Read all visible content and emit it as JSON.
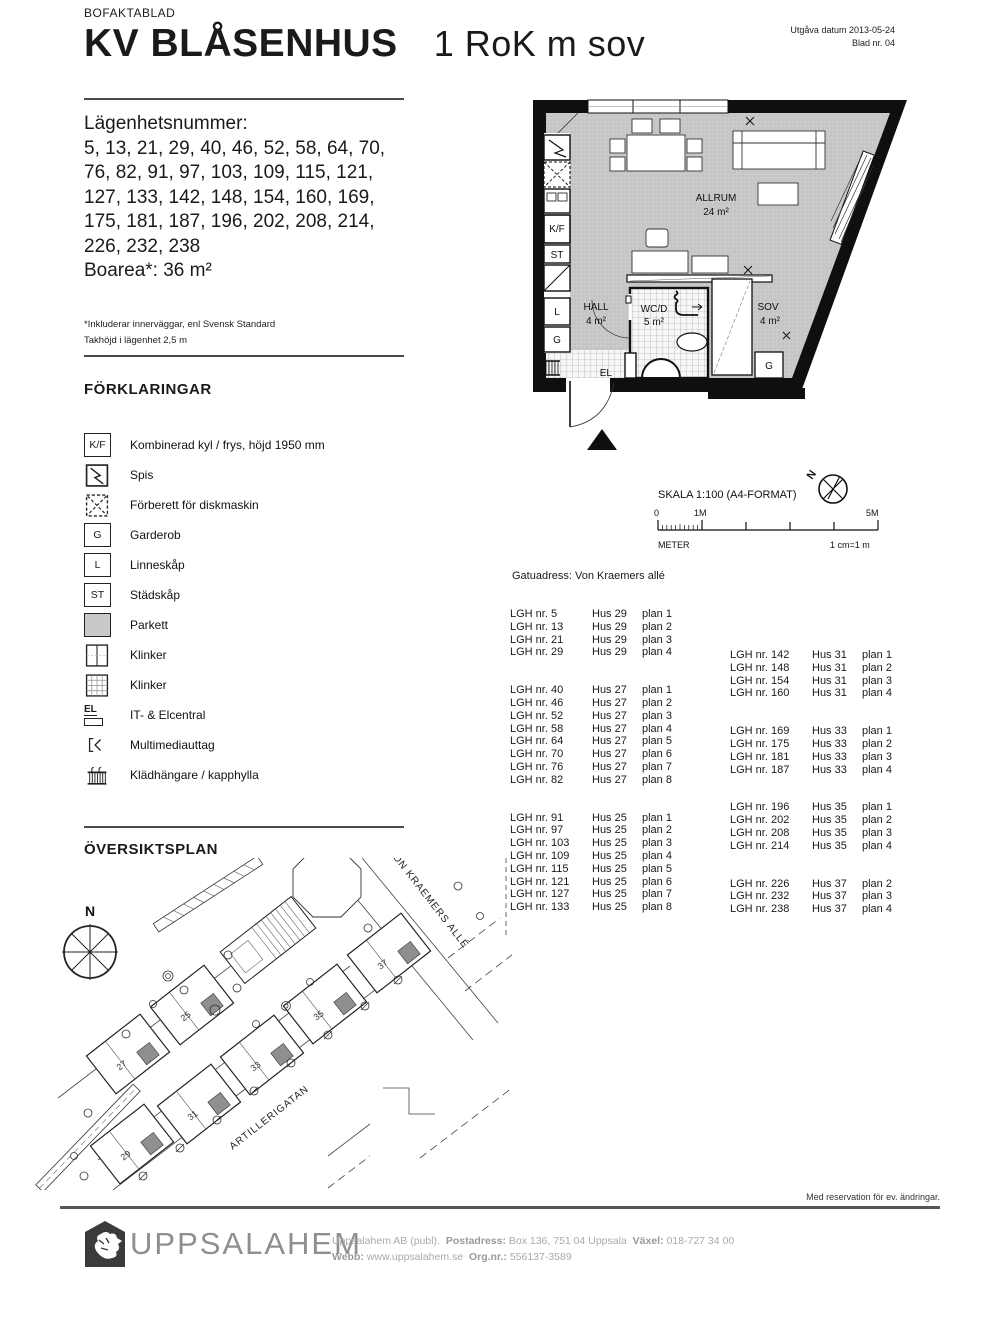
{
  "header": {
    "doc_type": "BOFAKTABLAD",
    "title": "KV BLÅSENHUS",
    "subtitle": "1 RoK m sov",
    "issue_date": "Utgåva datum 2013-05-24",
    "sheet_no": "Blad nr. 04"
  },
  "apartment": {
    "numbers_label": "Lägenhetsnummer:",
    "numbers": "5, 13, 21, 29, 40, 46, 52, 58, 64, 70, 76, 82, 91, 97, 103, 109, 115, 121, 127, 133, 142, 148, 154, 160, 169, 175, 181, 187, 196, 202, 208, 214, 226, 232, 238",
    "boarea": "Boarea*: 36 m²",
    "footnote1": "*Inkluderar innerväggar, enl Svensk Standard",
    "footnote2": "Takhöjd i lägenhet 2,5 m"
  },
  "legend": {
    "title": "FÖRKLARINGAR",
    "items": [
      {
        "icon": "kf-box",
        "symbol": "K/F",
        "label": "Kombinerad kyl / frys, höjd 1950 mm"
      },
      {
        "icon": "stove",
        "label": "Spis"
      },
      {
        "icon": "dishwasher",
        "label": "Förberett för diskmaskin"
      },
      {
        "icon": "g-box",
        "symbol": "G",
        "label": "Garderob"
      },
      {
        "icon": "l-box",
        "symbol": "L",
        "label": "Linneskåp"
      },
      {
        "icon": "st-box",
        "symbol": "ST",
        "label": "Städskåp"
      },
      {
        "icon": "parquet",
        "label": "Parkett"
      },
      {
        "icon": "tile-split",
        "label": "Klinker"
      },
      {
        "icon": "tile-grid",
        "label": "Klinker"
      },
      {
        "icon": "el-central",
        "symbol": "EL",
        "label": "IT- & Elcentral"
      },
      {
        "icon": "multimedia",
        "label": "Multimediauttag"
      },
      {
        "icon": "hanger",
        "label": "Klädhängare / kapphylla"
      }
    ]
  },
  "floorplan": {
    "allrum": "ALLRUM",
    "allrum_area": "24 m²",
    "hall": "HALL",
    "hall_area": "4 m²",
    "wc": "WC/D",
    "wc_area": "5 m²",
    "sov": "SOV",
    "sov_area": "4 m²",
    "el": "EL",
    "g": "G",
    "kf": "K/F",
    "st": "ST",
    "l": "L",
    "g2": "G"
  },
  "scalebar": {
    "title": "SKALA 1:100 (A4-FORMAT)",
    "tick_0": "0",
    "tick_1m": "1M",
    "tick_5m": "5M",
    "meter": "METER",
    "ratio": "1 cm=1 m",
    "north": "N"
  },
  "address": {
    "label": "Gatuadress: Von Kraemers allé"
  },
  "units": {
    "left_groups": [
      [
        {
          "lgh": "LGH nr. 5",
          "hus": "Hus 29",
          "plan": "plan 1"
        },
        {
          "lgh": "LGH nr. 13",
          "hus": "Hus 29",
          "plan": "plan 2"
        },
        {
          "lgh": "LGH nr. 21",
          "hus": "Hus 29",
          "plan": "plan 3"
        },
        {
          "lgh": "LGH nr. 29",
          "hus": "Hus 29",
          "plan": "plan 4"
        }
      ],
      [
        {
          "lgh": "LGH nr. 40",
          "hus": "Hus 27",
          "plan": "plan 1"
        },
        {
          "lgh": "LGH nr. 46",
          "hus": "Hus 27",
          "plan": "plan 2"
        },
        {
          "lgh": "LGH nr. 52",
          "hus": "Hus 27",
          "plan": "plan 3"
        },
        {
          "lgh": "LGH nr. 58",
          "hus": "Hus 27",
          "plan": "plan 4"
        },
        {
          "lgh": "LGH nr. 64",
          "hus": "Hus 27",
          "plan": "plan 5"
        },
        {
          "lgh": "LGH nr. 70",
          "hus": "Hus 27",
          "plan": "plan 6"
        },
        {
          "lgh": "LGH nr. 76",
          "hus": "Hus 27",
          "plan": "plan 7"
        },
        {
          "lgh": "LGH nr. 82",
          "hus": "Hus 27",
          "plan": "plan 8"
        }
      ],
      [
        {
          "lgh": "LGH nr. 91",
          "hus": "Hus 25",
          "plan": "plan 1"
        },
        {
          "lgh": "LGH nr. 97",
          "hus": "Hus 25",
          "plan": "plan 2"
        },
        {
          "lgh": "LGH nr. 103",
          "hus": "Hus 25",
          "plan": "plan 3"
        },
        {
          "lgh": "LGH nr. 109",
          "hus": "Hus 25",
          "plan": "plan 4"
        },
        {
          "lgh": "LGH nr. 115",
          "hus": "Hus 25",
          "plan": "plan 5"
        },
        {
          "lgh": "LGH nr. 121",
          "hus": "Hus 25",
          "plan": "plan 6"
        },
        {
          "lgh": "LGH nr. 127",
          "hus": "Hus 25",
          "plan": "plan 7"
        },
        {
          "lgh": "LGH nr. 133",
          "hus": "Hus 25",
          "plan": "plan 8"
        }
      ]
    ],
    "right_groups": [
      [
        {
          "lgh": "LGH nr. 142",
          "hus": "Hus 31",
          "plan": "plan 1"
        },
        {
          "lgh": "LGH nr. 148",
          "hus": "Hus 31",
          "plan": "plan 2"
        },
        {
          "lgh": "LGH nr. 154",
          "hus": "Hus 31",
          "plan": "plan 3"
        },
        {
          "lgh": "LGH nr. 160",
          "hus": "Hus 31",
          "plan": "plan 4"
        }
      ],
      [
        {
          "lgh": "LGH nr. 169",
          "hus": "Hus 33",
          "plan": "plan 1"
        },
        {
          "lgh": "LGH nr. 175",
          "hus": "Hus 33",
          "plan": "plan 2"
        },
        {
          "lgh": "LGH nr. 181",
          "hus": "Hus 33",
          "plan": "plan 3"
        },
        {
          "lgh": "LGH nr. 187",
          "hus": "Hus 33",
          "plan": "plan 4"
        }
      ],
      [
        {
          "lgh": "LGH nr. 196",
          "hus": "Hus 35",
          "plan": "plan 1"
        },
        {
          "lgh": "LGH nr. 202",
          "hus": "Hus 35",
          "plan": "plan 2"
        },
        {
          "lgh": "LGH nr. 208",
          "hus": "Hus 35",
          "plan": "plan 3"
        },
        {
          "lgh": "LGH nr. 214",
          "hus": "Hus 35",
          "plan": "plan 4"
        }
      ],
      [
        {
          "lgh": "LGH nr. 226",
          "hus": "Hus 37",
          "plan": "plan 2"
        },
        {
          "lgh": "LGH nr. 232",
          "hus": "Hus 37",
          "plan": "plan 3"
        },
        {
          "lgh": "LGH nr. 238",
          "hus": "Hus 37",
          "plan": "plan 4"
        }
      ]
    ]
  },
  "siteplan": {
    "title": "ÖVERSIKTSPLAN",
    "north": "N",
    "street_upper": "VON KRAEMERS ALLÉ",
    "street_lower": "ARTILLERIGATAN",
    "buildings": [
      "25",
      "27",
      "29",
      "31",
      "33",
      "35",
      "37"
    ]
  },
  "footer": {
    "reservation": "Med reservation för ev. ändringar.",
    "brand": "UPPSALAHEM",
    "company": "Uppsalahem AB (publ).",
    "post_label": "Postadress:",
    "post_value": "Box 136, 751 04 Uppsala",
    "phone_label": "Växel:",
    "phone_value": "018-727 34 00",
    "web_label": "Webb:",
    "web_value": "www.uppsalahem.se",
    "org_label": "Org.nr.:",
    "org_value": "556137-3589"
  }
}
